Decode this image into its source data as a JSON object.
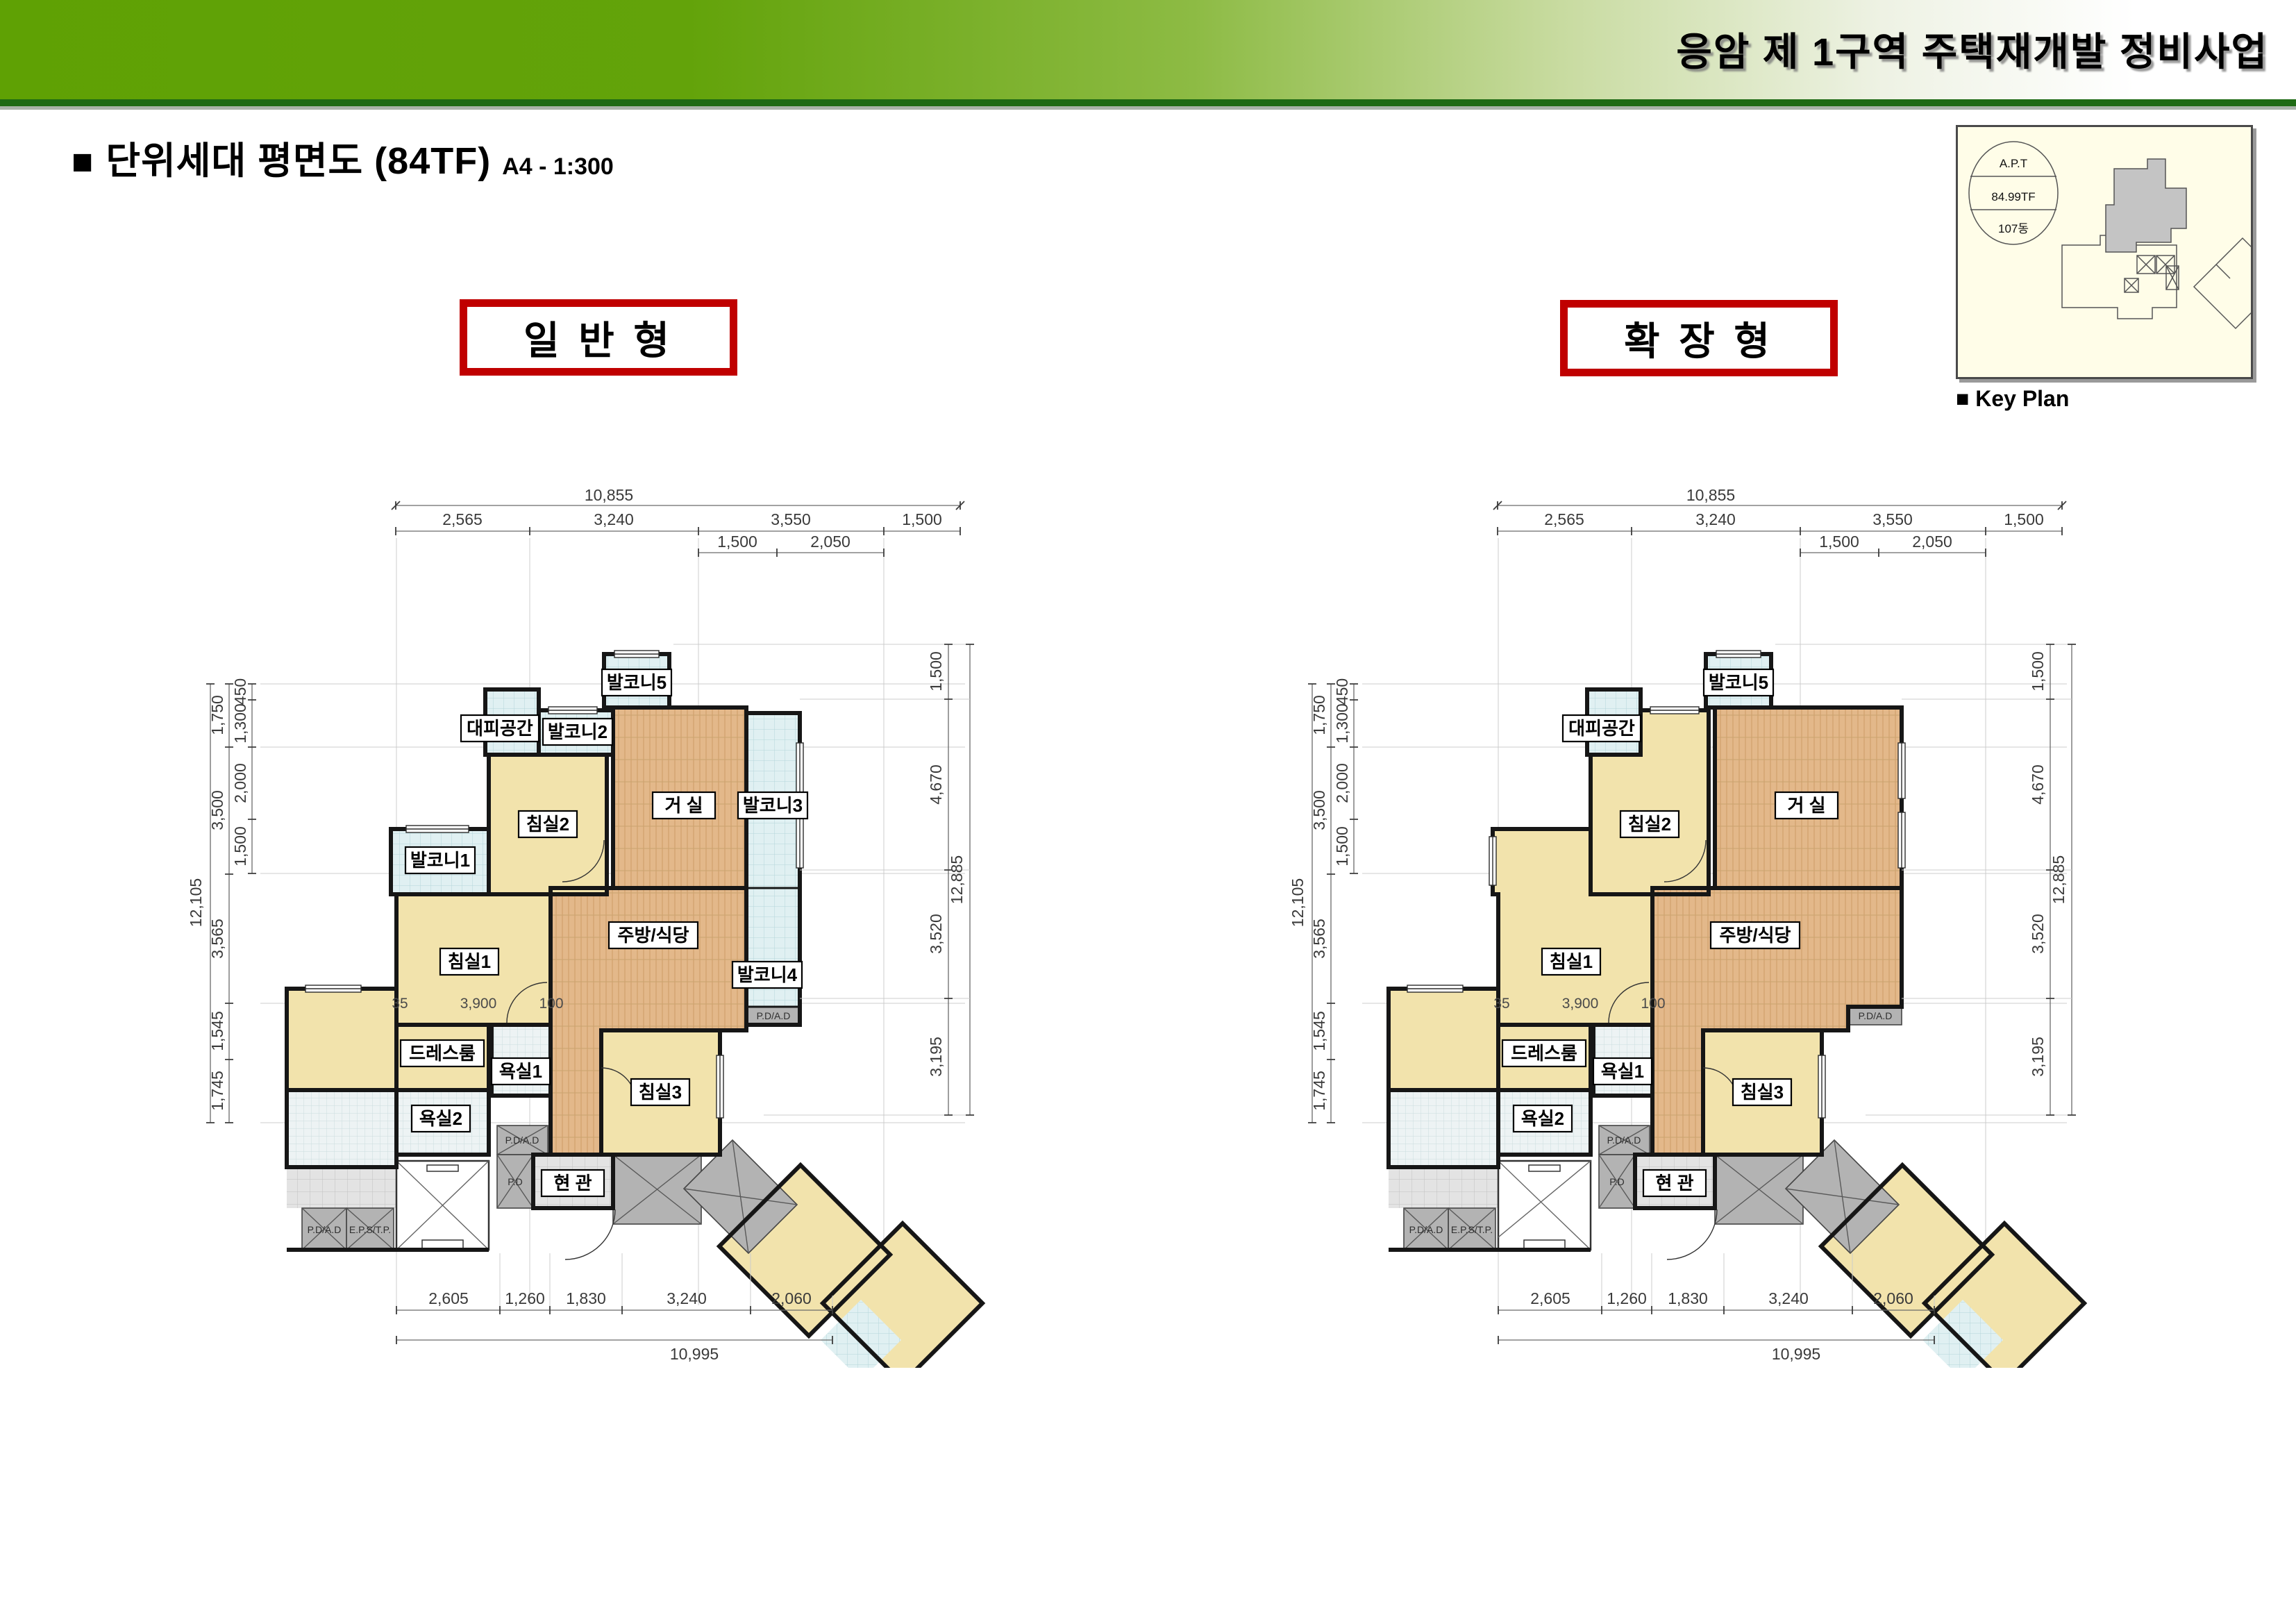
{
  "header": {
    "project_title": "응암 제 1구역 주택재개발 정비사업"
  },
  "page_title": {
    "bullet": "■",
    "main": "단위세대 평면도 (84TF)",
    "scale_note": "A4 - 1:300"
  },
  "type_labels": {
    "standard": "일 반 형",
    "extended": "확 장 형"
  },
  "key_plan": {
    "caption": "■ Key Plan",
    "stamp": {
      "line1": "A.P.T",
      "line2": "84.99TF",
      "line3": "107동"
    }
  },
  "rooms": {
    "living": "거 실",
    "kitchen": "주방/식당",
    "bed1": "침실1",
    "bed2": "침실2",
    "bed3": "침실3",
    "dress": "드레스룸",
    "bath1": "욕실1",
    "bath2": "욕실2",
    "entry": "현 관",
    "refuge": "대피공간",
    "balc1": "발코니1",
    "balc2": "발코니2",
    "balc3": "발코니3",
    "balc4": "발코니4",
    "balc5": "발코니5",
    "pdad": "P.D/A.D",
    "pd": "P.D",
    "eps": "E.P.S/T.P."
  },
  "dims": {
    "top_total": "10,855",
    "top": [
      "2,565",
      "3,240",
      "3,550",
      "1,500"
    ],
    "top_sub": [
      "1,500",
      "2,050"
    ],
    "left_total": "12,105",
    "left_outer": [
      "1,750",
      "3,500",
      "3,565",
      "1,545",
      "1,745"
    ],
    "left_inner": [
      "450",
      "1,300",
      "2,000",
      "1,500"
    ],
    "right_total": "12,885",
    "right": [
      "1,500",
      "4,670",
      "3,520",
      "3,195"
    ],
    "bottom_total": "10,995",
    "bottom": [
      "2,605",
      "1,260",
      "1,830",
      "3,240",
      "2,060"
    ],
    "interior": [
      "35",
      "3,900",
      "100"
    ]
  },
  "colors": {
    "header_green": "#5fa104",
    "underline_green": "#1e6a14",
    "accent_red": "#c00000",
    "cream": "#f2e3ac",
    "wood": "#e3b88a",
    "tile": "#e0f0f2",
    "service_gray": "#b3b3b3",
    "keyplan_bg": "#fffde8"
  }
}
